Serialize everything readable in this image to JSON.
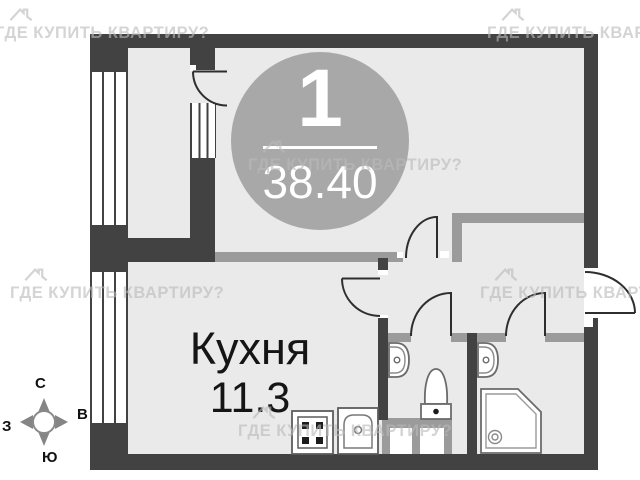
{
  "badge": {
    "apartment_number": "1",
    "total_area": "38.40"
  },
  "kitchen": {
    "label": "Кухня",
    "area": "11.3"
  },
  "compass": {
    "north": "С",
    "south": "Ю",
    "west": "З",
    "east": "В"
  },
  "watermark_text": "ГДЕ КУПИТЬ КВАРТИРУ?",
  "colors": {
    "exterior_wall": "#424242",
    "partition_wall": "#9b9b9b",
    "floor": "#eaeaea",
    "badge_circle": "#a8a8a8",
    "badge_text": "#ffffff",
    "watermark": "#c9c9c9"
  },
  "icons": {
    "house_watermark": "house-outline-icon",
    "compass": "compass-rose-icon",
    "fixtures": [
      "stove-icon",
      "kitchen-sink-icon",
      "toilet-icon",
      "bathroom-sink-icon",
      "bathroom-sink-icon",
      "shower-icon"
    ]
  }
}
